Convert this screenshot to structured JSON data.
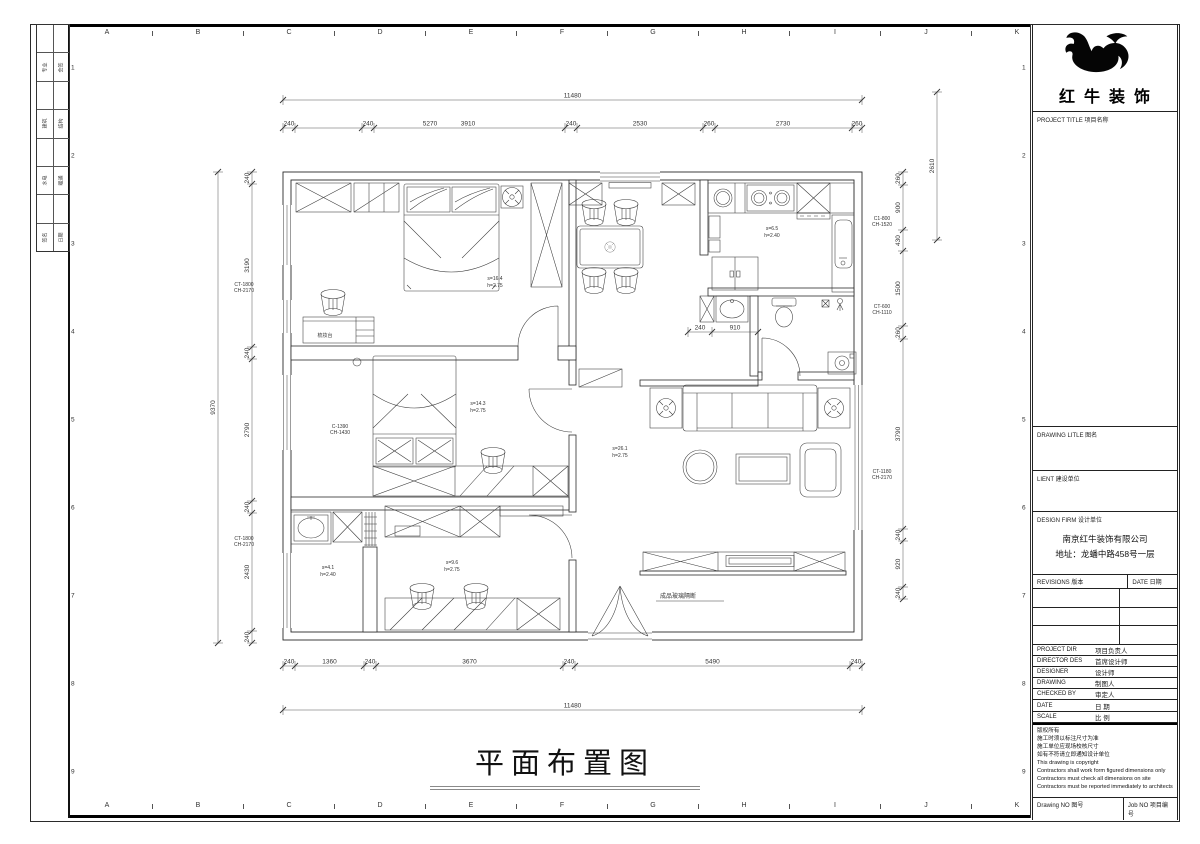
{
  "sheet": {
    "grid_letters": [
      "A",
      "B",
      "C",
      "D",
      "E",
      "F",
      "G",
      "H",
      "I",
      "J",
      "K"
    ],
    "grid_numbers": [
      "1",
      "2",
      "3",
      "4",
      "5",
      "6",
      "7",
      "8",
      "9"
    ],
    "signature_rows": [
      [
        "",
        ""
      ],
      [
        "专业",
        "会签"
      ],
      [
        "",
        ""
      ],
      [
        "建筑",
        "结构"
      ],
      [
        "",
        ""
      ],
      [
        "水电",
        "暖通"
      ],
      [
        "",
        ""
      ],
      [
        "签名",
        "日期"
      ]
    ]
  },
  "drawing": {
    "title": "平面布置图"
  },
  "plan": {
    "chains": [
      {
        "axis": "x",
        "o": 100,
        "b": [
          283,
          862
        ],
        "v": [
          "11480"
        ]
      },
      {
        "axis": "x",
        "o": 128,
        "b": [
          283,
          295,
          362,
          374,
          565,
          577,
          703,
          715,
          852,
          862
        ],
        "v": [
          "240",
          "240",
          "5270",
          "3910",
          "240",
          "2530",
          "260",
          "2730",
          "260"
        ],
        "lp": [
          289,
          368,
          430,
          468,
          571,
          640,
          709,
          783,
          857
        ]
      },
      {
        "axis": "x",
        "o": 666,
        "b": [
          283,
          295,
          364,
          376,
          563,
          575,
          850,
          862
        ],
        "v": [
          "240",
          "1360",
          "240",
          "3670",
          "240",
          "5490",
          "240"
        ]
      },
      {
        "axis": "x",
        "o": 710,
        "b": [
          283,
          862
        ],
        "v": [
          "11480"
        ]
      },
      {
        "axis": "y",
        "o": 252,
        "b": [
          172,
          184,
          347,
          359,
          501,
          513,
          631,
          643
        ],
        "v": [
          "240",
          "3190",
          "240",
          "2790",
          "240",
          "2430",
          "240"
        ]
      },
      {
        "axis": "y",
        "o": 218,
        "b": [
          172,
          643
        ],
        "v": [
          "9370"
        ]
      },
      {
        "axis": "y",
        "o": 903,
        "b": [
          172,
          185,
          230,
          251,
          326,
          339,
          529,
          541,
          587,
          599
        ],
        "v": [
          "260",
          "900",
          "430",
          "1500",
          "260",
          "3790",
          "240",
          "920",
          "240"
        ]
      },
      {
        "axis": "y",
        "o": 937,
        "b": [
          92,
          240
        ],
        "v": [
          "2610"
        ]
      },
      {
        "axis": "x",
        "o": 332,
        "b": [
          688,
          712,
          758
        ],
        "v": [
          "240",
          "910"
        ]
      }
    ],
    "labels": [
      {
        "x": 495,
        "y": 280,
        "t": "s=16.4",
        "s": 5
      },
      {
        "x": 495,
        "y": 287,
        "t": "h=2.75",
        "s": 5
      },
      {
        "x": 478,
        "y": 405,
        "t": "s=14.3",
        "s": 5
      },
      {
        "x": 478,
        "y": 412,
        "t": "h=2.75",
        "s": 5
      },
      {
        "x": 620,
        "y": 450,
        "t": "s=26.1",
        "s": 5
      },
      {
        "x": 620,
        "y": 457,
        "t": "h=2.75",
        "s": 5
      },
      {
        "x": 452,
        "y": 564,
        "t": "s=9.6",
        "s": 5
      },
      {
        "x": 452,
        "y": 571,
        "t": "h=2.75",
        "s": 5
      },
      {
        "x": 328,
        "y": 569,
        "t": "s=4.1",
        "s": 5
      },
      {
        "x": 328,
        "y": 576,
        "t": "h=2.40",
        "s": 5
      },
      {
        "x": 772,
        "y": 230,
        "t": "s=6.5",
        "s": 5
      },
      {
        "x": 772,
        "y": 237,
        "t": "h=2.40",
        "s": 5
      },
      {
        "x": 325,
        "y": 337,
        "t": "梳妆台",
        "s": 5
      },
      {
        "x": 244,
        "y": 286,
        "t": "CT-1800",
        "s": 5
      },
      {
        "x": 244,
        "y": 292,
        "t": "CH-2170",
        "s": 5
      },
      {
        "x": 244,
        "y": 540,
        "t": "CT-1800",
        "s": 5
      },
      {
        "x": 244,
        "y": 546,
        "t": "CH-2170",
        "s": 5
      },
      {
        "x": 340,
        "y": 428,
        "t": "C-1390",
        "s": 5
      },
      {
        "x": 340,
        "y": 434,
        "t": "CH-1430",
        "s": 5
      },
      {
        "x": 882,
        "y": 220,
        "t": "C1-800",
        "s": 5
      },
      {
        "x": 882,
        "y": 226,
        "t": "CH-1520",
        "s": 5
      },
      {
        "x": 882,
        "y": 308,
        "t": "CT-600",
        "s": 5
      },
      {
        "x": 882,
        "y": 314,
        "t": "CH-1110",
        "s": 5
      },
      {
        "x": 882,
        "y": 473,
        "t": "CT-1180",
        "s": 5
      },
      {
        "x": 882,
        "y": 479,
        "t": "CH-2170",
        "s": 5
      },
      {
        "x": 660,
        "y": 598,
        "t": "成品玻璃隔断",
        "s": 6,
        "a": "start"
      }
    ]
  },
  "titleblock": {
    "logo_text": "红牛装饰",
    "project_title_label": "PROJECT TITLE  项目名称",
    "drawing_title_label": "DRAWING LITLE  图名",
    "client_label": "LIENT  建设单位",
    "design_firm_label": "DESIGN FIRM  设计单位",
    "firm_name": "南京红牛装饰有限公司",
    "firm_addr": "地址：龙蟠中路458号一层",
    "revisions_label": "REVISIONS  版本",
    "date_col_label": "DATE  日期",
    "fields": [
      {
        "en": "PROJECT DIR",
        "cn": "项目负责人"
      },
      {
        "en": "DIRECTOR DES",
        "cn": "首席设计师"
      },
      {
        "en": "DESIGNER",
        "cn": "设计师"
      },
      {
        "en": "DRAWING",
        "cn": "制图人"
      },
      {
        "en": "CHECKED BY",
        "cn": "审定人"
      },
      {
        "en": "DATE",
        "cn": "日  期"
      },
      {
        "en": "SCALE",
        "cn": "比  例"
      }
    ],
    "copyright": [
      "版权所有",
      "施工时须以标注尺寸为准",
      "施工单位应现场校核尺寸",
      "如有不符请立即通知设计单位",
      "This drawing is copyright",
      "Contractors shall work form figured dimensions only",
      "Contractors must check all dimensions on site",
      "Contractors must be reported immediately to architects"
    ],
    "drawing_no_label": "Drawing NO  图号",
    "job_no_label": "Job NO  项目编号"
  }
}
